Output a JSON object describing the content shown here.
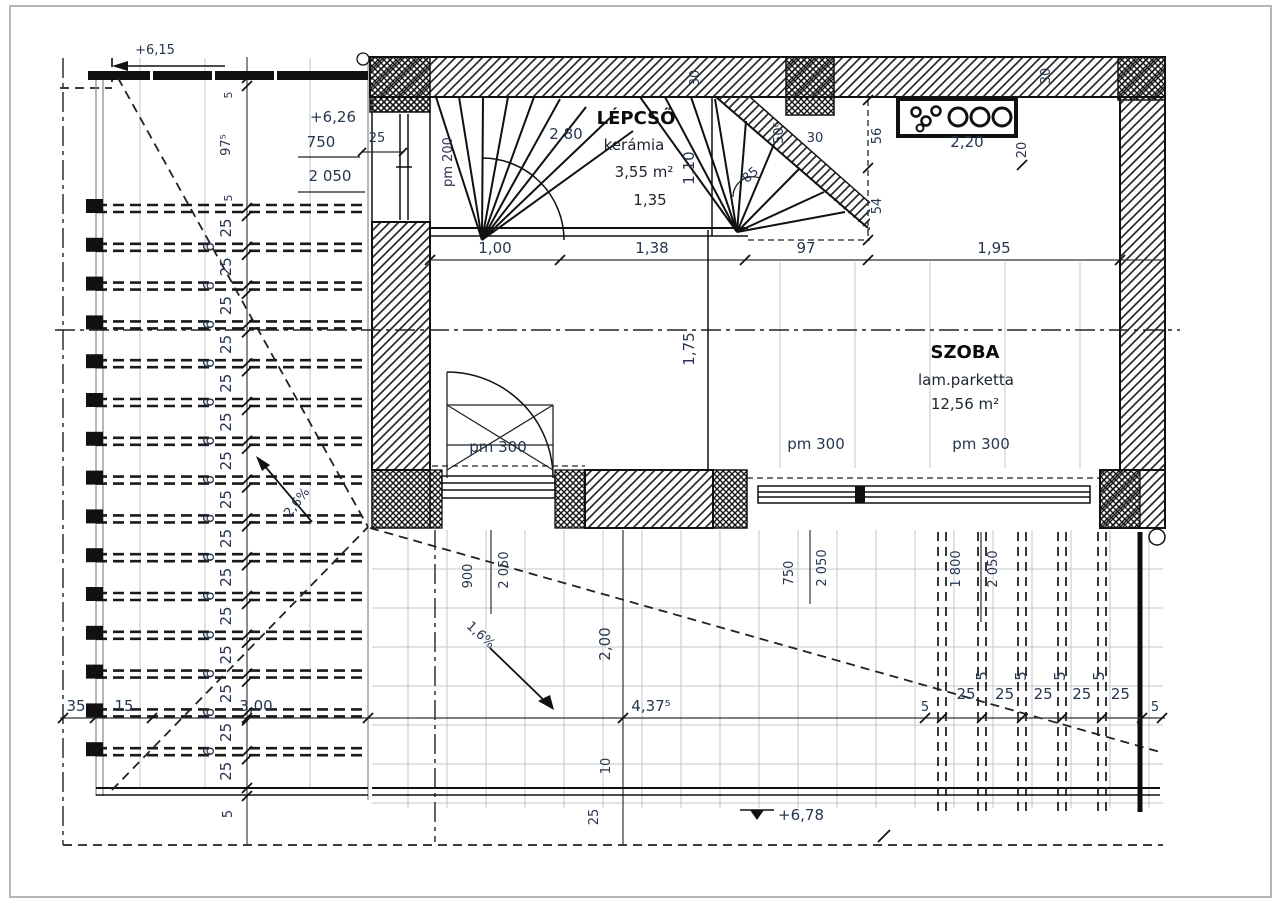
{
  "rooms": {
    "lepcso": {
      "name": "LÉPCSŐ",
      "material": "kerámia",
      "area": "3,55 m²",
      "tread": "1,35"
    },
    "szoba": {
      "name": "SZOBA",
      "material": "lam.parketta",
      "area": "12,56 m²"
    }
  },
  "levels": {
    "top_left": "+6,15",
    "upper_floor": "+6,26",
    "terrace": "+6,78"
  },
  "slopes": {
    "deck": "2,6%",
    "terrace": "1,6%"
  },
  "parapets": {
    "stair": "pm 200",
    "door": "pm 300",
    "window1": "pm 300",
    "window2": "pm 300"
  },
  "window_specs": {
    "left_wall": {
      "w": "750",
      "h": "2 050"
    },
    "szoba_left": {
      "w": "900",
      "h": "2 050"
    },
    "szoba_bottom1": {
      "w": "750",
      "h": "2 050"
    },
    "szoba_bottom2": {
      "w": "1 800",
      "h": "2 050"
    }
  },
  "dims": {
    "wall_thickness": "25",
    "stair_width": "2,80",
    "stair_d1": "1,10",
    "top_wall_a": "30",
    "top_wall_b": "30",
    "kitchen_width": "2,20",
    "kitchen_gap": "20",
    "stair_r1": "50⁶",
    "stair_r2": "30",
    "stair_angle": "85",
    "right_chain_a": "56",
    "right_chain_b": "54",
    "run": [
      "1,00",
      "1,38",
      "97",
      "1,95"
    ],
    "room_width": "1,75",
    "terrace_h": "2,00",
    "terrace_w": "4,37⁵",
    "edge": "10",
    "border": "25",
    "bottom_left": [
      "35",
      "15",
      "3,00"
    ],
    "beam_gaps": [
      "25",
      "25",
      "25",
      "25",
      "25"
    ],
    "beam_small": [
      "5",
      "5",
      "5",
      "5"
    ],
    "beam_end_left": "5",
    "beam_end_right": "5",
    "chain_top": [
      "5",
      "97⁵",
      "5"
    ],
    "chain_25": [
      "25",
      "25",
      "25",
      "25",
      "25",
      "25",
      "25",
      "25",
      "25",
      "25",
      "25",
      "25",
      "25",
      "25",
      "25"
    ],
    "chain_6": [
      "6",
      "6",
      "6",
      "6",
      "6",
      "6",
      "6",
      "6",
      "6",
      "6",
      "6",
      "6",
      "6",
      "6"
    ],
    "chain_bottom": "5"
  }
}
